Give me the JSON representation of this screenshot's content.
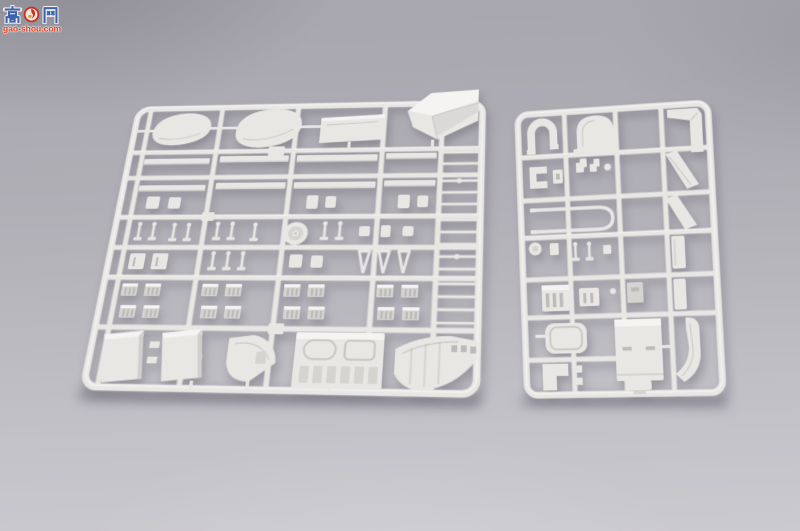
{
  "watermark": {
    "char_left": "高",
    "char_right": "网",
    "site_url": "gao-shou.com",
    "emblem_icon": "red-seal-emblem"
  },
  "colors": {
    "bg-top": "#a7a5ad",
    "bg-bottom": "#cbcacf",
    "plastic": "#e9e7e4",
    "plastic-light": "#f5f4f2",
    "plastic-dark": "#d6d4d1",
    "plastic-darker": "#bdbbb9",
    "wm-blue": "#3a63ae",
    "wm-red": "#cf2d1b",
    "wm-url": "#e23a18"
  },
  "scene": {
    "objects": [
      "left-parts-sprue",
      "right-parts-sprue"
    ]
  }
}
